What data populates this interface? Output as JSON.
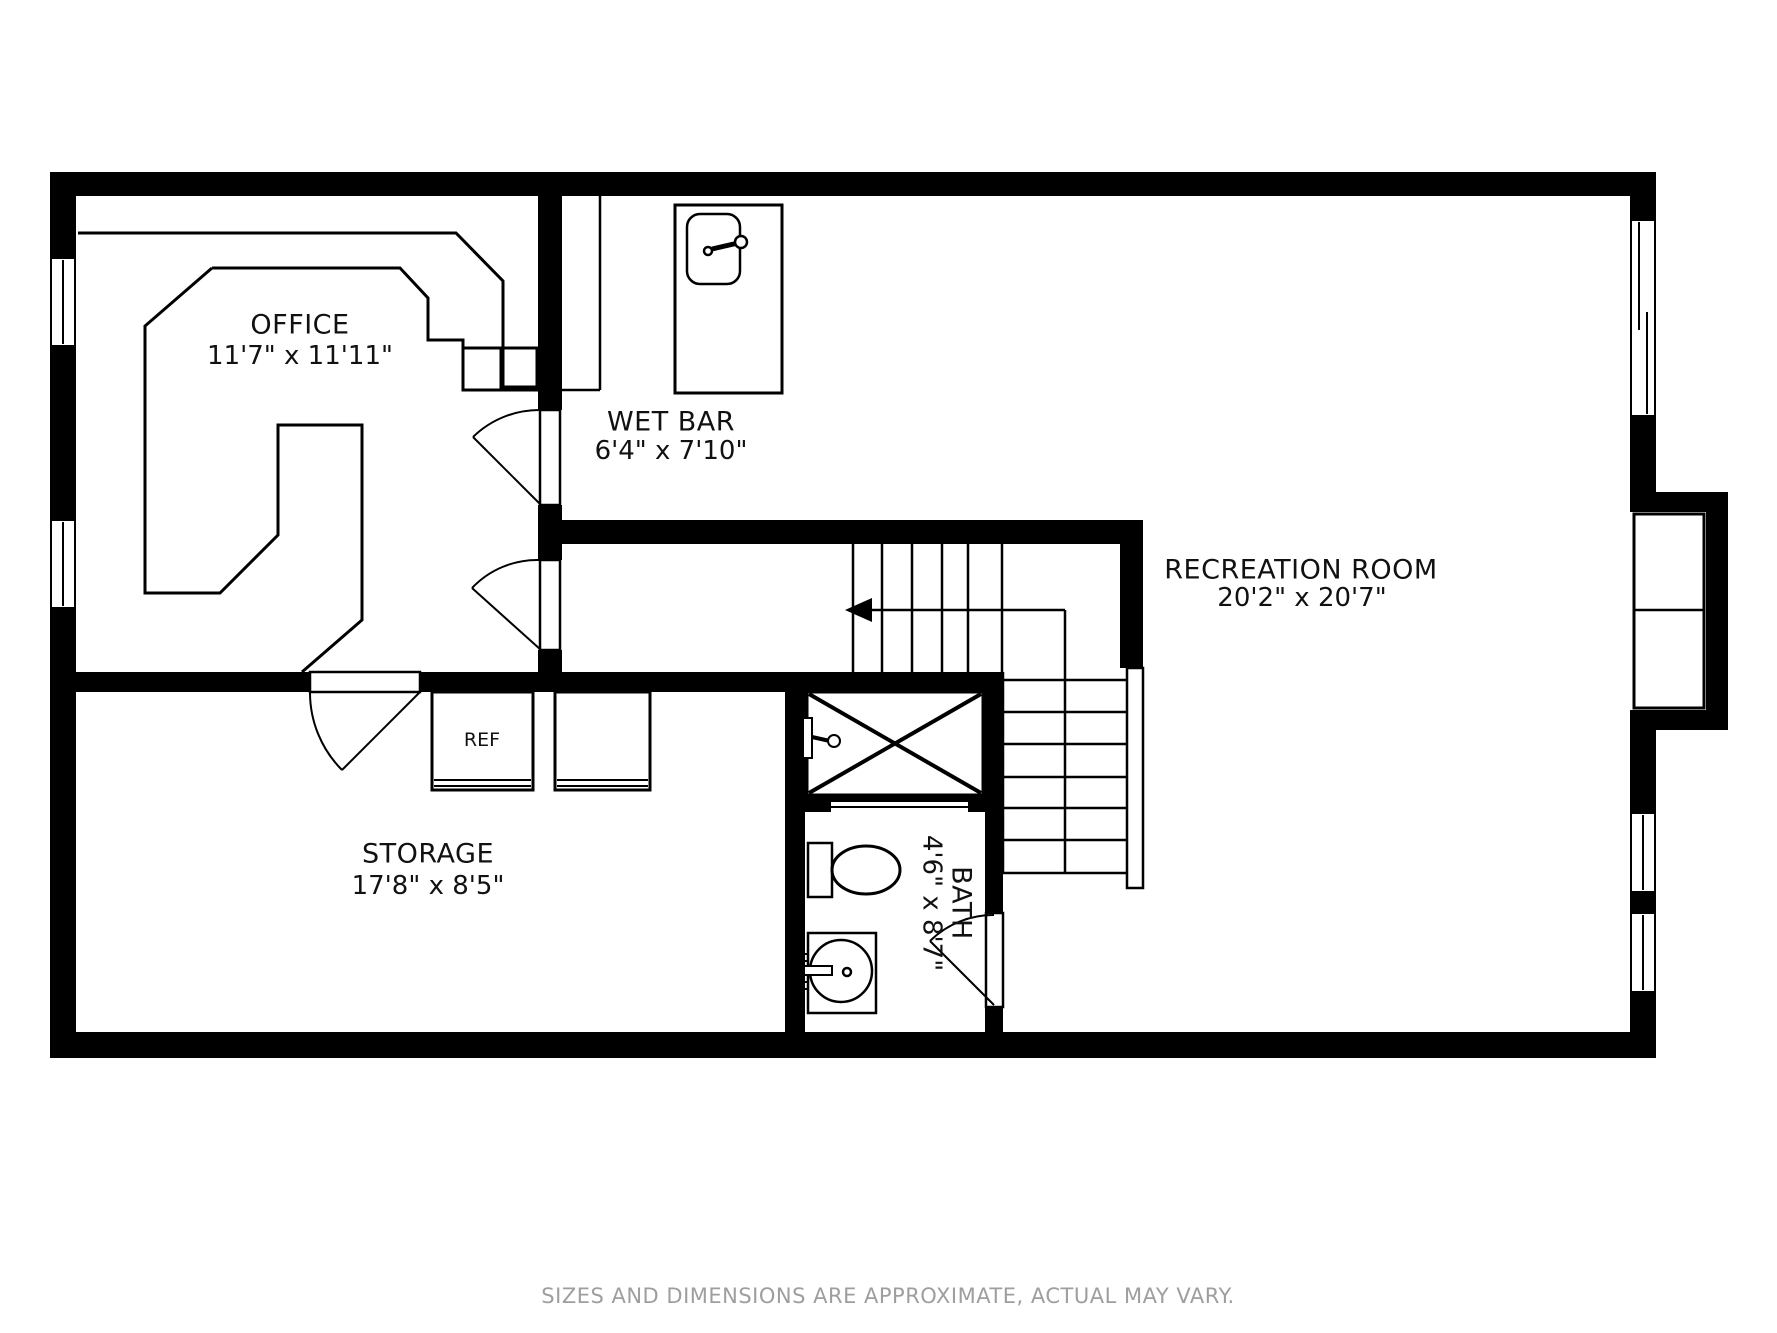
{
  "page": {
    "background_color": "#ffffff",
    "wall_color": "#000000",
    "line_color": "#1a1a1a",
    "muted_text_color": "#9e9e9e"
  },
  "rooms": {
    "office": {
      "name": "OFFICE",
      "dimensions": "11'7\" x 11'11\""
    },
    "wet_bar": {
      "name": "WET BAR",
      "dimensions": "6'4\" x 7'10\""
    },
    "recreation_room": {
      "name": "RECREATION ROOM",
      "dimensions": "20'2\" x 20'7\""
    },
    "storage": {
      "name": "STORAGE",
      "dimensions": "17'8\" x 8'5\""
    },
    "bath": {
      "name": "BATH",
      "dimensions": "4'6\" x 8'7\""
    }
  },
  "appliances": {
    "refrigerator_label": "REF"
  },
  "fixtures": {
    "wet_bar_sink": "sink-icon",
    "bath_sink": "sink-icon",
    "toilet": "toilet-icon",
    "shower": "shower-icon",
    "stairs": "stairs-icon",
    "stairs_direction": "arrow-left-icon",
    "windows": "window-icon",
    "doors": "door-swing-icon",
    "fireplace_niche": "niche-icon"
  },
  "footer": {
    "disclaimer": "SIZES AND DIMENSIONS ARE APPROXIMATE, ACTUAL MAY VARY."
  }
}
